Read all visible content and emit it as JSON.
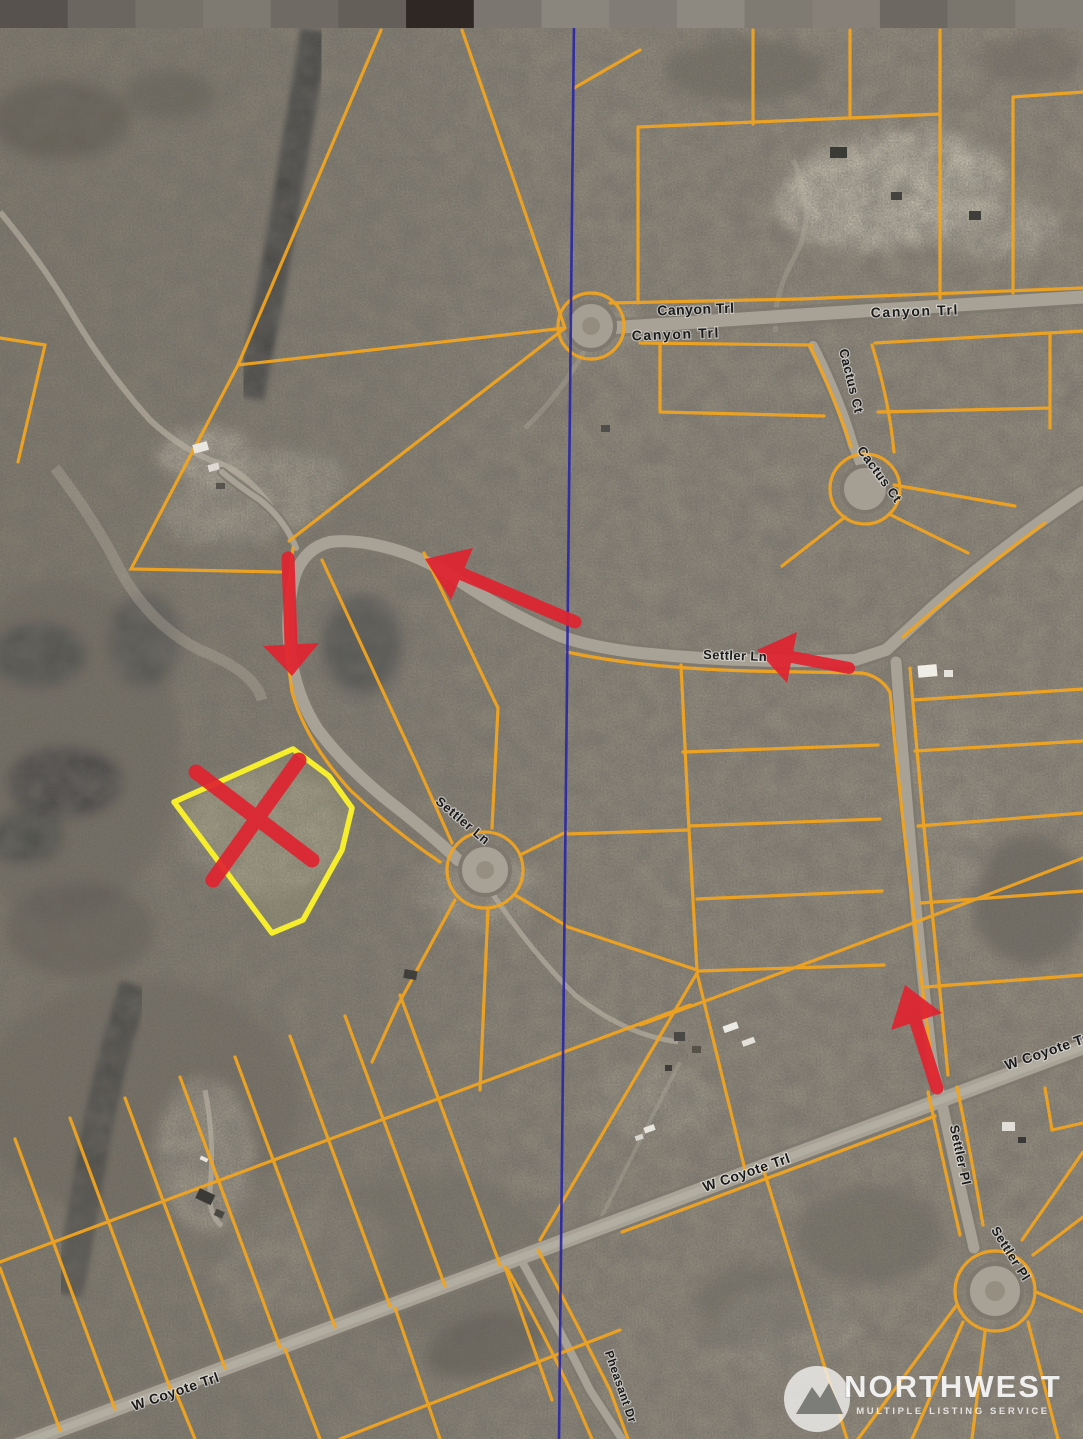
{
  "map": {
    "title": "Aerial parcel map with plat overlay",
    "road_labels": [
      {
        "text": "Canyon Trl",
        "x": 696,
        "y": 314,
        "rotate": -2,
        "size": 14,
        "spacing": 0.5
      },
      {
        "text": "Canyon Trl",
        "x": 915,
        "y": 316,
        "rotate": -2,
        "size": 14,
        "spacing": 1.6
      },
      {
        "text": "Canyon Trl",
        "x": 676,
        "y": 339,
        "rotate": -2,
        "size": 14,
        "spacing": 1.6
      },
      {
        "text": "Cactus Ct",
        "x": 847,
        "y": 382,
        "rotate": 76,
        "size": 13,
        "spacing": 0.6
      },
      {
        "text": "Cactus Ct",
        "x": 876,
        "y": 477,
        "rotate": 54,
        "size": 13,
        "spacing": 0.6
      },
      {
        "text": "Settler Ln",
        "x": 735,
        "y": 660,
        "rotate": 2,
        "size": 13,
        "spacing": 0.4
      },
      {
        "text": "Settler Ln",
        "x": 460,
        "y": 824,
        "rotate": 40,
        "size": 13,
        "spacing": 0.6
      },
      {
        "text": "W Coyote Trl",
        "x": 748,
        "y": 1177,
        "rotate": -19,
        "size": 14,
        "spacing": 0.5
      },
      {
        "text": "W Coyote Tr",
        "x": 1048,
        "y": 1056,
        "rotate": -19,
        "size": 14,
        "spacing": 0.5
      },
      {
        "text": "W Coyote Trl",
        "x": 177,
        "y": 1396,
        "rotate": -19,
        "size": 14,
        "spacing": 0.5
      },
      {
        "text": "Settler Pl",
        "x": 956,
        "y": 1156,
        "rotate": 78,
        "size": 13,
        "spacing": 0.5
      },
      {
        "text": "Settler Pl",
        "x": 1007,
        "y": 1256,
        "rotate": 58,
        "size": 13,
        "spacing": 0.5
      },
      {
        "text": "Pheasant Dr",
        "x": 617,
        "y": 1388,
        "rotate": 71,
        "size": 12,
        "spacing": 0.5
      }
    ],
    "watermark": {
      "title": "NORTHWEST",
      "subtitle": "MULTIPLE LISTING SERVICE"
    },
    "annotations": {
      "parcel_highlight_color": "#f6ee2d",
      "marker_color": "#e02330",
      "section_line_color": "#2a28a6",
      "parcel_line_color": "#f1a41f",
      "arrow_count": 4,
      "highlight": "Subject lot outlined in yellow with red X",
      "route": "Red arrows trace route from W Coyote Trl up Settler Pl and west along Settler Ln to the lot"
    }
  }
}
